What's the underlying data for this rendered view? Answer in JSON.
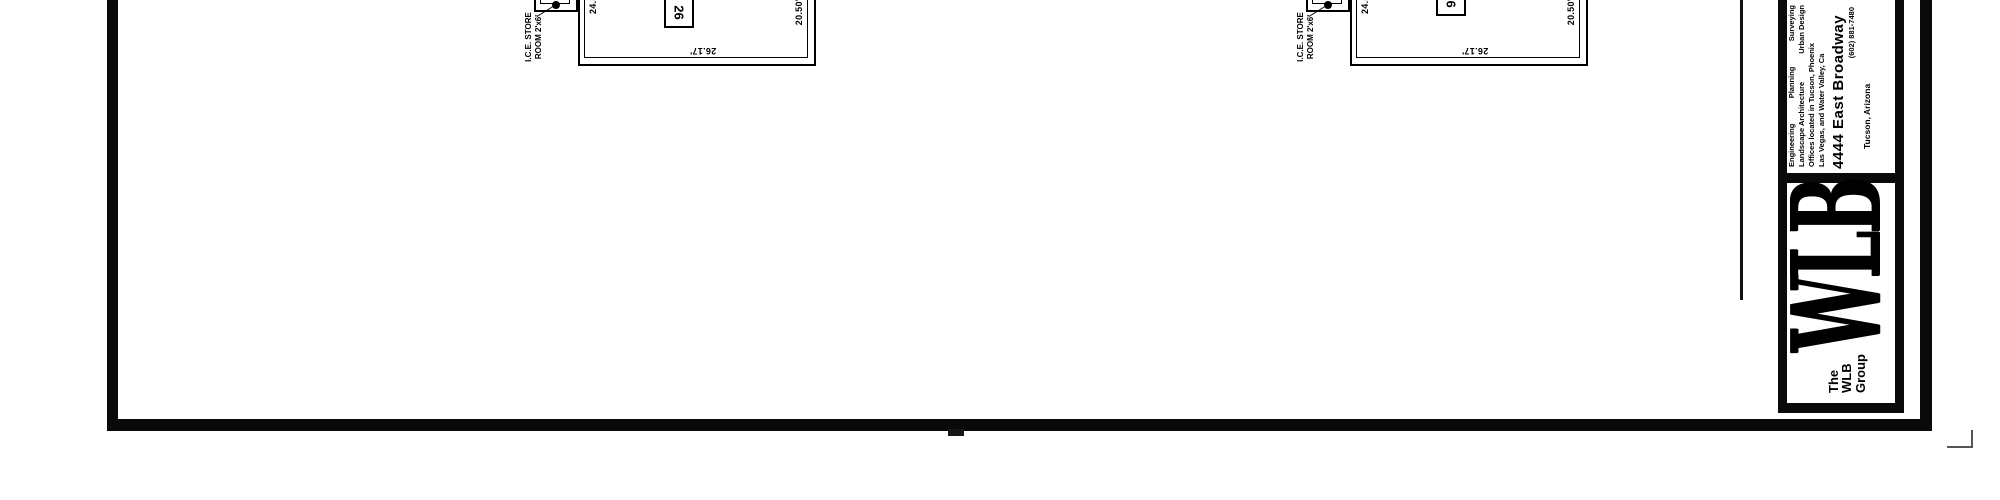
{
  "drawing": {
    "plans": [
      {
        "room_label_line1": "I.C.E. STORE",
        "room_label_line2": "ROOM 2'x6'",
        "dim_left": "24.50'",
        "dim_bottom": "26.17'",
        "dim_right": "20.50'",
        "keynote": "26"
      },
      {
        "room_label_line1": "I.C.E. STORE",
        "room_label_line2": "ROOM 2'x6'",
        "dim_left": "24.50'",
        "dim_bottom": "26.17'",
        "dim_right": "20.50'",
        "keynote": "26"
      }
    ]
  },
  "title_block": {
    "services": [
      "Engineering",
      "Planning",
      "Surveying"
    ],
    "disciplines": [
      "Landscape Architecture",
      "Urban Design"
    ],
    "offices_line1": "Offices located in Tucson, Phoenix",
    "offices_line2": "Las Vegas, and Water Valley, Ca",
    "address": "4444 East Broadway",
    "phone": "(602) 881-7480",
    "city": "Tucson, Arizona",
    "logo": {
      "small_line1": "The",
      "small_line2": "WLB",
      "small_line3": "Group",
      "big": "WLB"
    }
  },
  "colors": {
    "ink": "#0a0a0a",
    "paper": "#ffffff"
  }
}
